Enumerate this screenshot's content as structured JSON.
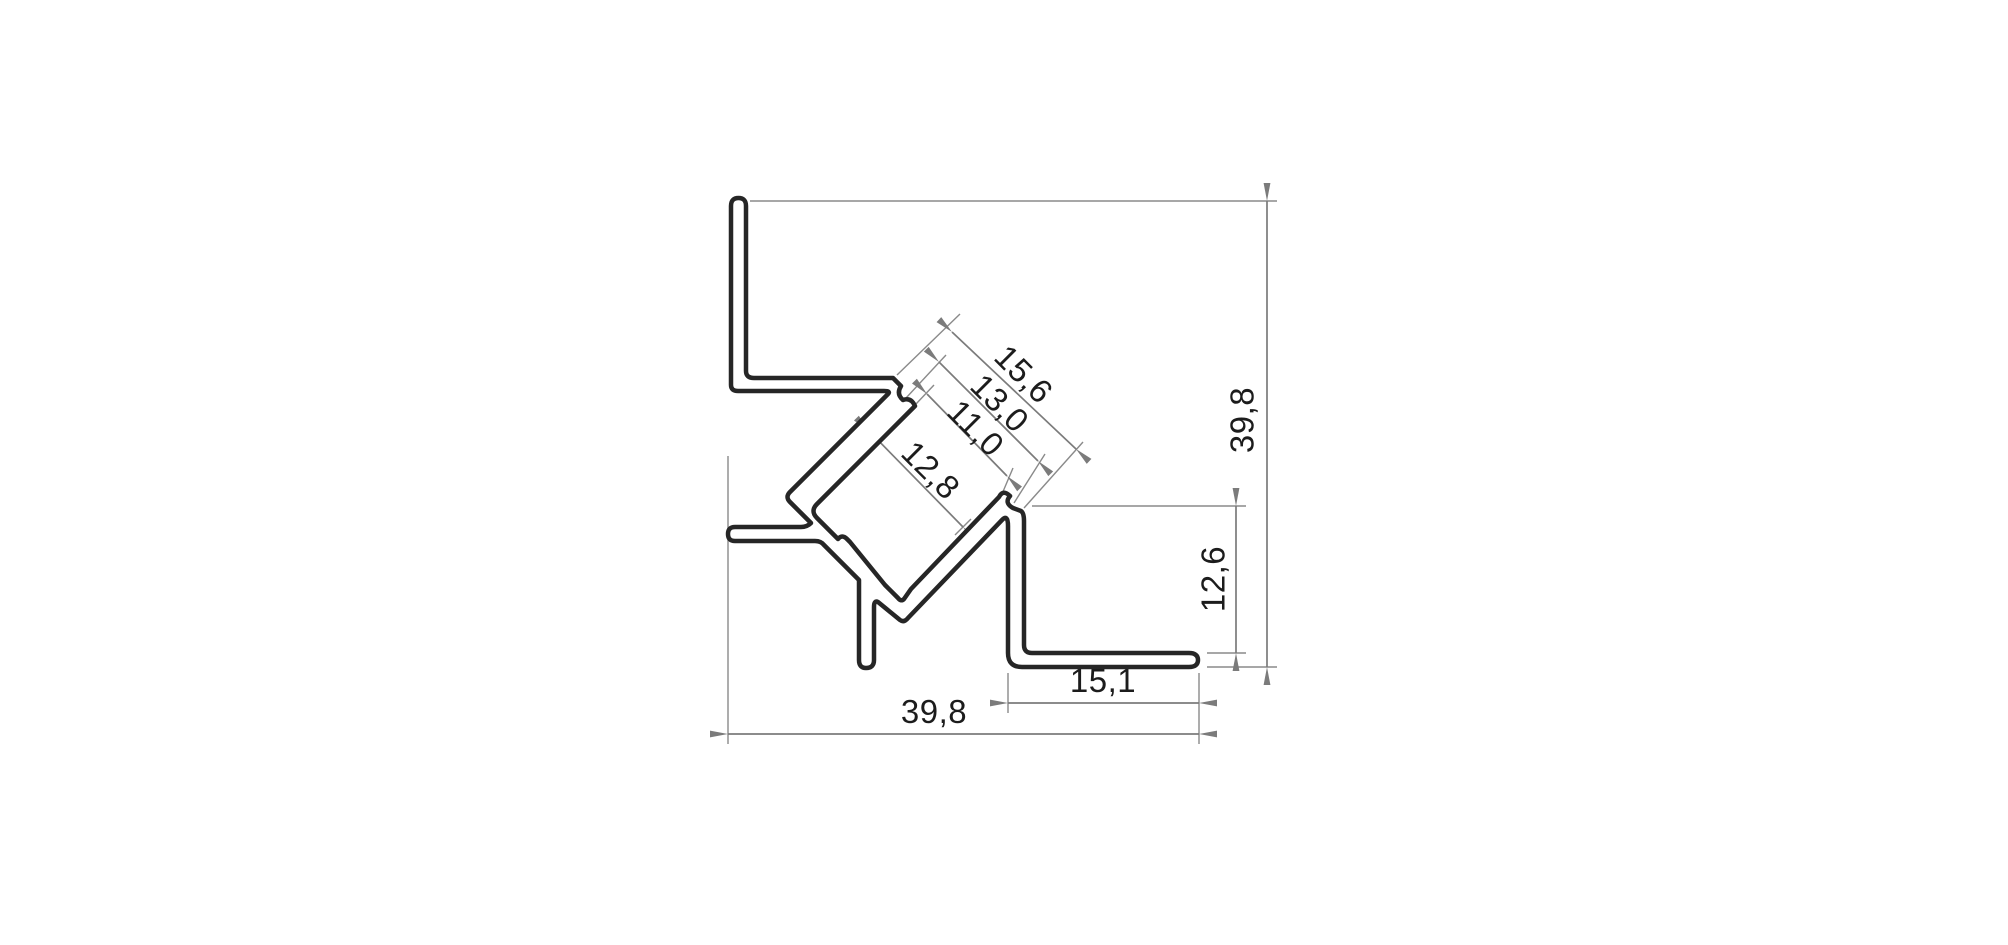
{
  "drawing": {
    "type": "technical-cross-section",
    "subject": "45-degree corner aluminium LED profile",
    "background_color": "#ffffff",
    "outline_color": "#262626",
    "dimension_line_color": "#7b7b7b",
    "dimension_text_color": "#1c1c1c",
    "dimensions": {
      "slot_outer_width": {
        "label": "15,6",
        "orientation": "diagonal-45"
      },
      "slot_shoulder_width": {
        "label": "13,0",
        "orientation": "diagonal-45"
      },
      "slot_tip_width": {
        "label": "11,0",
        "orientation": "diagonal-45"
      },
      "channel_inner_width": {
        "label": "12,8",
        "orientation": "diagonal-45"
      },
      "overall_height": {
        "label": "39,8",
        "orientation": "vertical"
      },
      "leg_height": {
        "label": "12,6",
        "orientation": "vertical"
      },
      "foot_width": {
        "label": "15,1",
        "orientation": "horizontal"
      },
      "overall_width": {
        "label": "39,8",
        "orientation": "horizontal"
      }
    }
  }
}
